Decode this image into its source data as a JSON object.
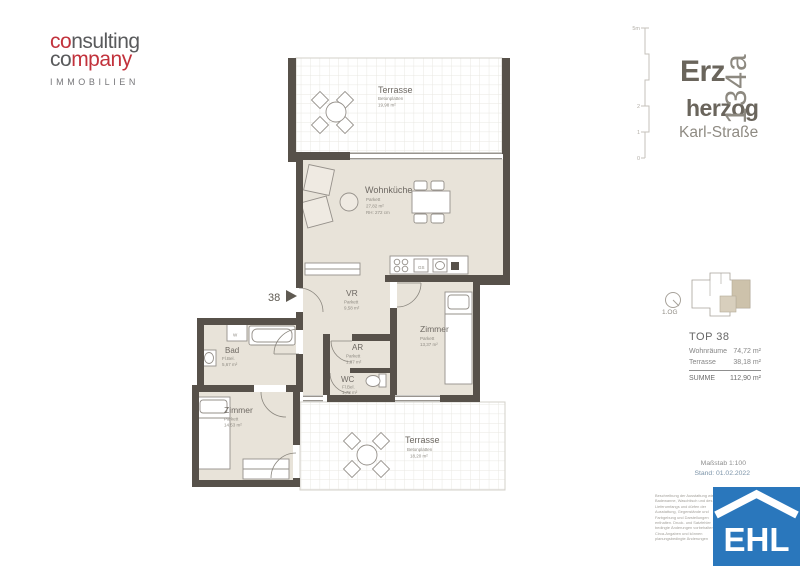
{
  "colors": {
    "accent_red": "#c2323c",
    "logo_gray": "#595a5c",
    "wall": "#57514a",
    "floor_beige": "#e8e3d9",
    "highlight_beige": "#cdc2ab",
    "ehl_blue": "#2a77bc"
  },
  "logo": {
    "word1_a": "co",
    "word1_b": "nsulting",
    "word2_a": "co",
    "word2_b": "mpany",
    "subtitle": "IMMOBILIEN"
  },
  "project": {
    "line1": "Erz",
    "line2": "herzog",
    "line3": "Karl-Straße",
    "number": "134a"
  },
  "scalebar": {
    "top": "5m",
    "m2": "2",
    "m1": "1",
    "m0": "0"
  },
  "plan": {
    "entrance_label": "38",
    "rooms": {
      "terrasse_top": {
        "name": "Terrasse",
        "floor": "Betonplatten",
        "area": "19,98 m²"
      },
      "wohnkueche": {
        "name": "Wohnküche",
        "floor": "Parkett",
        "area": "27,82 m²",
        "rh": "RH: 272 cm"
      },
      "vr": {
        "name": "VR",
        "floor": "Parkett",
        "area": "9,58 m²"
      },
      "zimmer_ost": {
        "name": "Zimmer",
        "floor": "Parkett",
        "area": "13,37 m²"
      },
      "ar": {
        "name": "AR",
        "floor": "Parkett",
        "area": "1,87 m²"
      },
      "wc": {
        "name": "WC",
        "floor": "Fl.Bel.",
        "area": "1,78 m²"
      },
      "bad": {
        "name": "Bad",
        "floor": "Fl.Bel.",
        "area": "5,67 m²",
        "washer": "W"
      },
      "zimmer_west": {
        "name": "Zimmer",
        "floor": "Parkett",
        "area": "14,53 m²"
      },
      "terrasse_sued": {
        "name": "Terrasse",
        "floor": "Betonplatten",
        "area": "18,20 m²"
      }
    },
    "kitchen": {
      "gs": "GS"
    }
  },
  "sidebar": {
    "floor": "1.OG",
    "unit_title": "TOP 38",
    "rows": [
      {
        "label": "Wohnräume",
        "value": "74,72 m²"
      },
      {
        "label": "Terrasse",
        "value": "38,18 m²"
      }
    ],
    "total_label": "SUMME",
    "total_value": "112,90 m²"
  },
  "footer": {
    "scale": "Maßstab 1:100",
    "date": "Stand: 01.02.2022",
    "disclaimer": [
      "Beschreibung der Ausstattung wie",
      "Badewanne, Waschtisch und des",
      "Lieferumfangs und dürfen der",
      "Ausstattung, Gegenstände und",
      "Farbgebung und Darstellungen",
      "enthalten. Druck- und Satzfehler",
      "bedingte Änderungen vorbehalten.",
      "Circa-Angaben und können",
      "planungsbedingte Änderungen"
    ],
    "ehl": "EHL"
  }
}
